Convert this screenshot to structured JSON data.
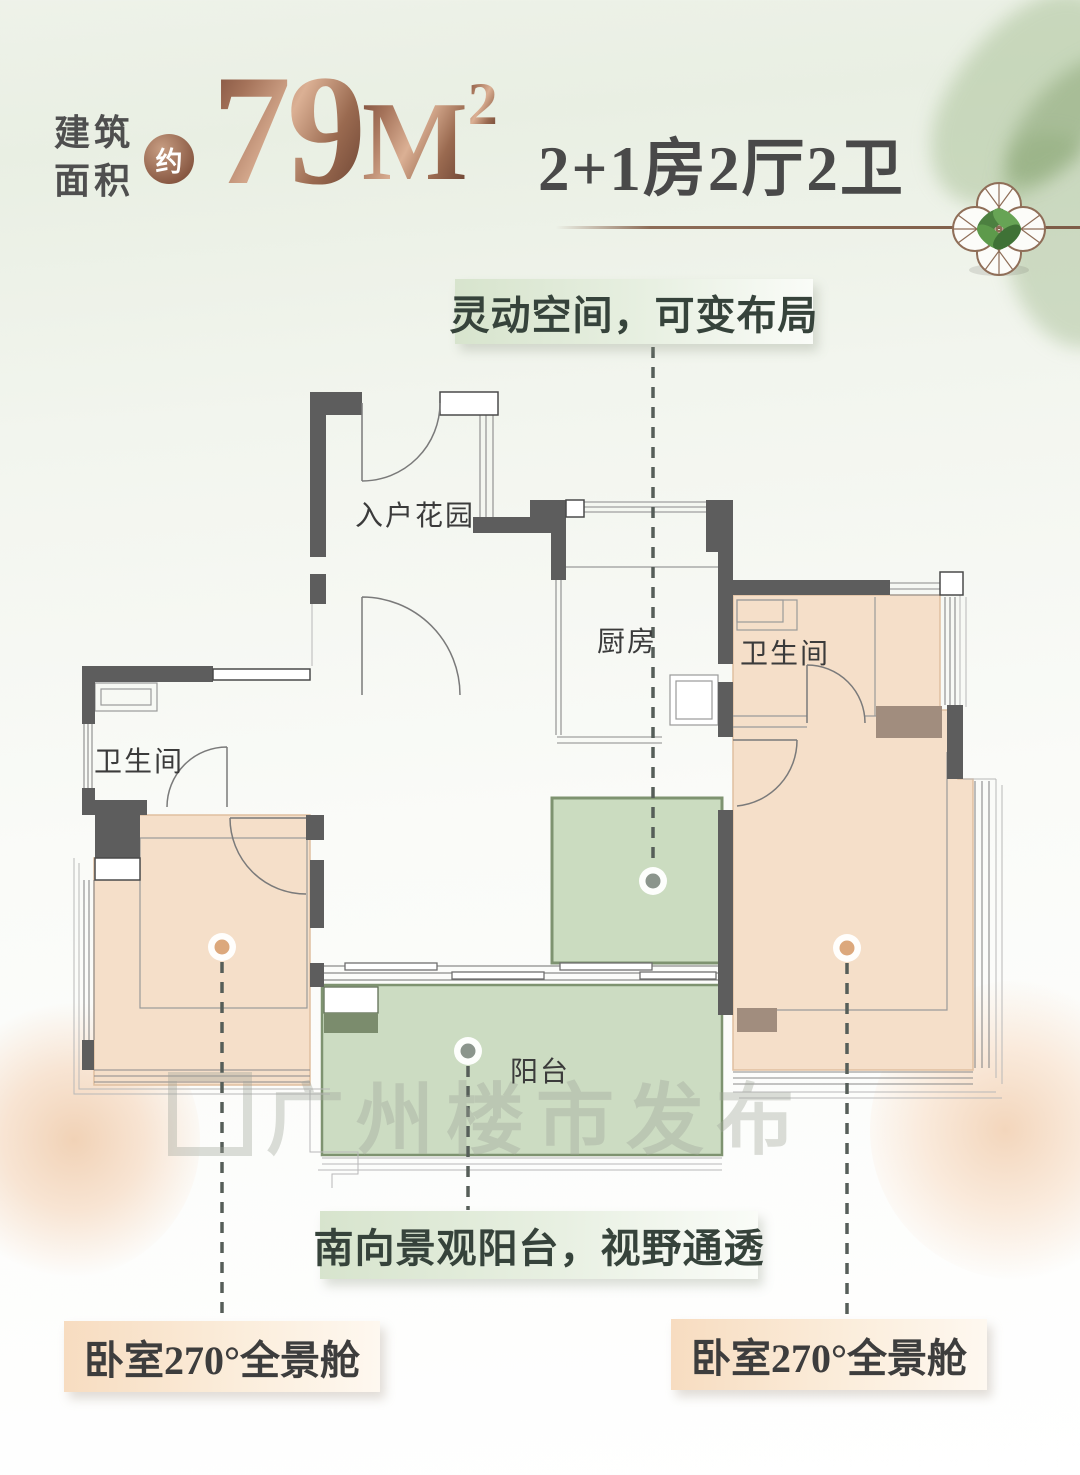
{
  "header": {
    "area_label_line1": "建筑",
    "area_label_line2": "面积",
    "approx_badge": "约",
    "area_value": "79",
    "area_unit": "M",
    "area_sup": "2",
    "layout_text": "2+1房2厅2卫"
  },
  "rooms": {
    "entry_garden": "入户花园",
    "kitchen": "厨房",
    "bath_right": "卫生间",
    "bath_left": "卫生间",
    "balcony": "阳台"
  },
  "callouts": {
    "flex_space": "灵动空间，可变布局",
    "balcony_view": "南向景观阳台，视野通透",
    "bedroom_left": "卧室270°全景舱",
    "bedroom_right": "卧室270°全景舱"
  },
  "watermark": "广州楼市发布",
  "colors": {
    "bronze": "#8d6c57",
    "wall_gray": "#5d5d5d",
    "room_peach": "#f5dfc9",
    "room_green": "#cbdcc0",
    "callout_green_bg": "#d7e4cd",
    "callout_peach_bg": "#f7dcc0",
    "dot_orange": "#dca87c",
    "dot_gray": "#8b958c"
  }
}
